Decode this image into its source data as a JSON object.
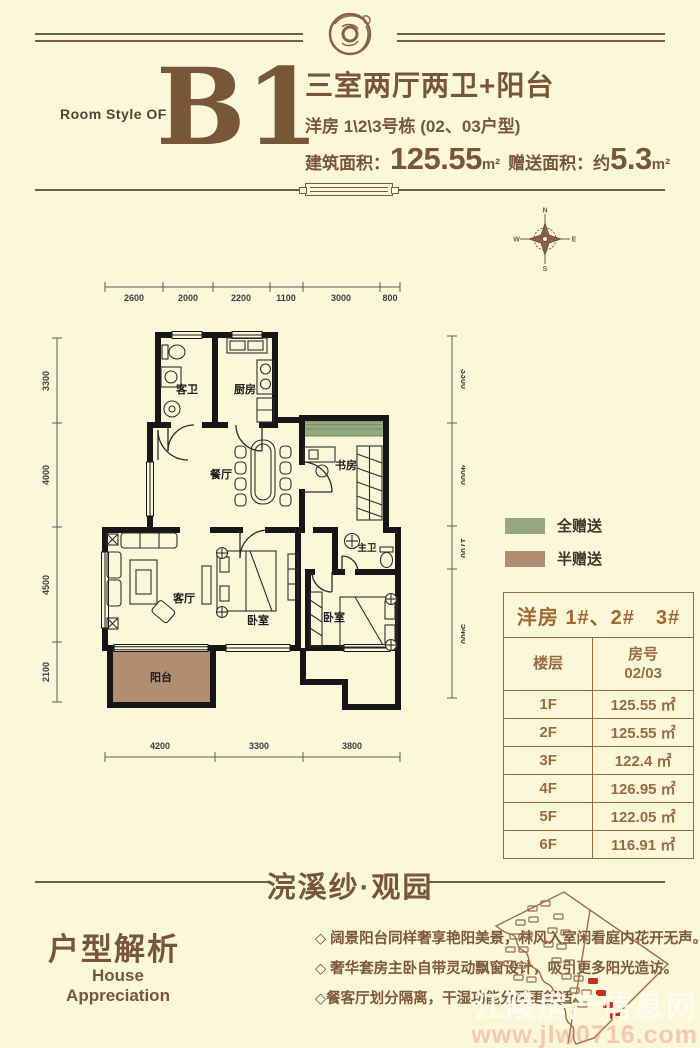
{
  "header": {
    "room_style_label": "Room Style OF",
    "unit_code": "B1",
    "title": "三室两厅两卫+阳台",
    "subtitle": "洋房 1\\2\\3号栋 (02、03户型)",
    "area_label": "建筑面积：",
    "area_value": "125.55",
    "area_unit": "m²",
    "gift_label": "赠送面积：",
    "gift_prefix": "约",
    "gift_value": "5.3",
    "gift_unit": "m²"
  },
  "compass": {
    "n": "N",
    "e": "E",
    "s": "S",
    "w": "W"
  },
  "floorplan": {
    "rooms": {
      "guest_bath": "客卫",
      "kitchen": "厨房",
      "dining": "餐厅",
      "study": "书房",
      "master_bath": "主卫",
      "living": "客厅",
      "bedroom_mid": "卧室",
      "bedroom_right": "卧室",
      "balcony": "阳台"
    },
    "dims": {
      "top": [
        "2600",
        "2000",
        "2200",
        "1100",
        "3000",
        "800"
      ],
      "left": [
        "3300",
        "4000",
        "4500",
        "2100"
      ],
      "right": [
        "3300",
        "4000",
        "1700",
        "5400"
      ],
      "bottom": [
        "4200",
        "3300",
        "3800"
      ]
    },
    "colors": {
      "full_gift": "#94a77e",
      "half_gift": "#b18d72",
      "walls": "#161616"
    }
  },
  "legend": {
    "full_gift": {
      "label": "全赠送",
      "color": "#94a77e"
    },
    "half_gift": {
      "label": "半赠送",
      "color": "#b18d72"
    }
  },
  "table": {
    "title": "洋房 1#、2#　3#",
    "col_floor": "楼层",
    "col_room": "房号",
    "col_room_sub": "02/03",
    "rows": [
      {
        "floor": "1F",
        "area": "125.55 ㎡"
      },
      {
        "floor": "2F",
        "area": "125.55 ㎡"
      },
      {
        "floor": "3F",
        "area": "122.4 ㎡"
      },
      {
        "floor": "4F",
        "area": "126.95 ㎡"
      },
      {
        "floor": "5F",
        "area": "122.05 ㎡"
      },
      {
        "floor": "6F",
        "area": "116.91 ㎡"
      }
    ]
  },
  "footer": {
    "project_name": "浣溪纱·观园",
    "section_title": "户型解析",
    "section_en_1": "House",
    "section_en_2": "Appreciation",
    "bullets": [
      "◇ 阔景阳台同样奢享艳阳美景，林风入室闲看庭内花开无声。",
      "◇ 奢华套房主卧自带灵动飘窗设计，吸引更多阳光造访。",
      "◇餐客厅划分隔离，干湿功能分区更舒适。"
    ]
  },
  "watermark": {
    "line1": "江陵房产信息网",
    "line2": "www.jlw0716.com"
  }
}
